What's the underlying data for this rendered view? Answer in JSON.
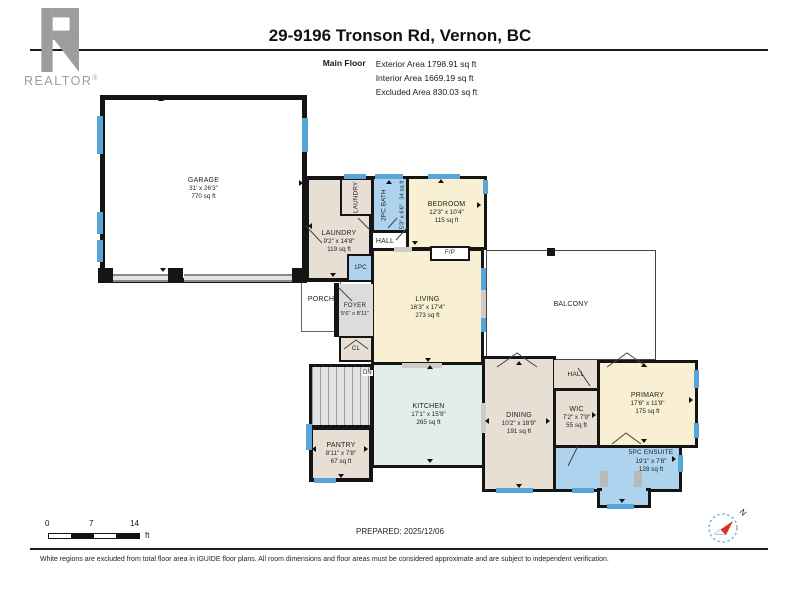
{
  "header": {
    "logo_text": "REALTOR",
    "logo_reg": "®",
    "title": "29-9196 Tronson Rd, Vernon, BC",
    "floor_label": "Main Floor",
    "stats": [
      "Exterior Area 1798.91 sq ft",
      "Interior Area 1669.19 sq ft",
      "Excluded Area 830.03 sq ft"
    ]
  },
  "rooms": {
    "garage": {
      "name": "GARAGE",
      "dims": "31' x 26'3\"",
      "area": "770 sq ft"
    },
    "laundry": {
      "name": "LAUNDRY",
      "dims": "9'2\" x 14'8\"",
      "area": "119 sq ft"
    },
    "laundry_closet": {
      "name": "LAUNDRY"
    },
    "bath": {
      "name": "2PC BATH",
      "dims": "5'3\" x 6'6\"",
      "area": "34 sq ft"
    },
    "bedroom": {
      "name": "BEDROOM",
      "dims": "12'3\" x 10'4\"",
      "area": "115 sq ft"
    },
    "hall_upper": {
      "name": "HALL"
    },
    "wc": {
      "name": "1PC"
    },
    "fireplace": {
      "name": "F/P"
    },
    "porch": {
      "name": "PORCH"
    },
    "foyer": {
      "name": "FOYER",
      "dims": "5'6\" x 8'11\""
    },
    "living": {
      "name": "LIVING",
      "dims": "16'3\" x 17'4\"",
      "area": "273 sq ft"
    },
    "balcony": {
      "name": "BALCONY"
    },
    "closet": {
      "name": "CL"
    },
    "stairs": {
      "name": "DN"
    },
    "pantry": {
      "name": "PANTRY",
      "dims": "8'11\" x 7'8\"",
      "area": "67 sq ft"
    },
    "kitchen": {
      "name": "KITCHEN",
      "dims": "17'1\" x 15'9\"",
      "area": "265 sq ft"
    },
    "dining": {
      "name": "DINING",
      "dims": "10'2\" x 18'9\"",
      "area": "191 sq ft"
    },
    "hall_lower": {
      "name": "HALL"
    },
    "wic": {
      "name": "WIC",
      "dims": "7'2\" x 7'9\"",
      "area": "55 sq ft"
    },
    "primary": {
      "name": "PRIMARY",
      "dims": "17'6\" x 11'9\"",
      "area": "175 sq ft"
    },
    "ensuite": {
      "name": "5PC ENSUITE",
      "dims": "19'1\" x 7'8\"",
      "area": "128 sq ft"
    }
  },
  "scale": {
    "ticks": [
      "0",
      "7",
      "14"
    ],
    "unit": "ft"
  },
  "footer": {
    "prepared": "PREPARED: 2025/12/06",
    "compass_n": "N",
    "disclaimer": "White regions are excluded from total floor area in iGUIDE floor plans. All room dimensions and floor areas must be considered approximate and are subject to independent verification."
  },
  "colors": {
    "window_blue": "#58a6d8",
    "room_beige": "#e7dfd3",
    "room_cream": "#f9efd2",
    "room_blue": "#aed3ee",
    "room_teal": "#e2efe9",
    "hall_gray": "#dcdcdc",
    "wall": "#151515",
    "compass_red": "#d93025",
    "logo_gray": "#9d9d9d"
  }
}
